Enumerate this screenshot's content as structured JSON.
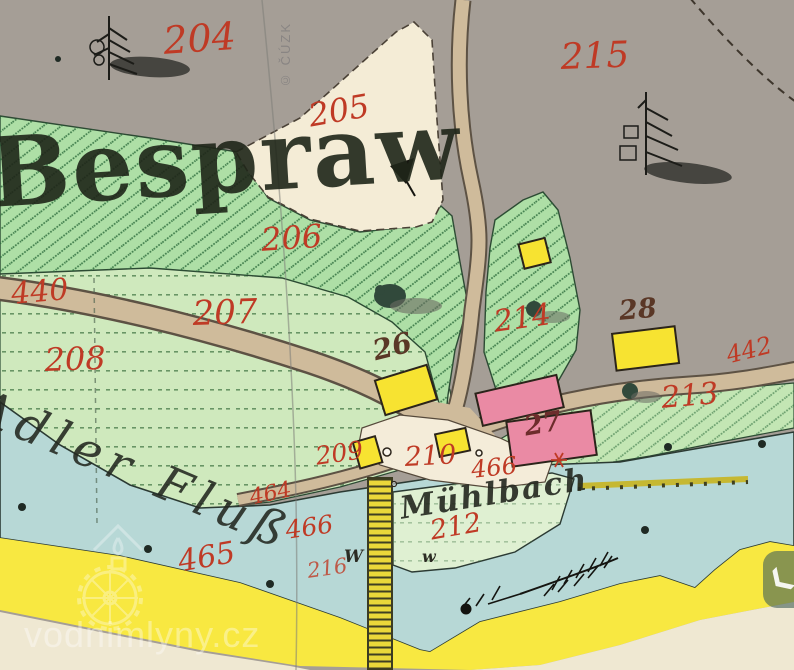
{
  "map": {
    "title": "Historic cadastral map sheet",
    "labels": {
      "place": "Bespraw",
      "river": "Adler Fluß",
      "stream": "Mühlbach",
      "p204": "204",
      "p215": "215",
      "p205": "205",
      "p206": "206",
      "p207": "207",
      "p208": "208",
      "p440": "440",
      "p214": "214",
      "p213": "213",
      "p442": "442",
      "p209": "209",
      "p210": "210",
      "p466_upper": "466",
      "p464": "464",
      "p466_lower": "466",
      "p465": "465",
      "p216": "216",
      "p212": "212",
      "h26": "26",
      "h27": "27",
      "h28": "28",
      "w_marker_left": "W",
      "w_marker_right": "w"
    },
    "symbols": {
      "conifer_trees": 2,
      "mill_star": "red six-ray star",
      "reed_marsh": "feather sprig with dot",
      "meadow_letter": "W"
    }
  },
  "colors": {
    "parcel_number_red": "#bf3a25",
    "house_number_ink": "#5a3726",
    "paper_gray": "#a59e96",
    "paper_cream": "#efe8d2",
    "garden_green": "#aedfa6",
    "meadow_green": "#cfe9bd",
    "island_green": "#dff0d2",
    "water_blue": "#b7d8d6",
    "road_tan": "#cfbb9b",
    "band_yellow": "#f8e841",
    "building_yellow": "#f7e331",
    "building_pink": "#ea8aa4",
    "map_ink": "#23271f"
  },
  "watermark": {
    "site": "vodnimlyny.cz",
    "archive_credit": "© ČÚZK"
  },
  "ui": {
    "nav_icon": "❮"
  }
}
